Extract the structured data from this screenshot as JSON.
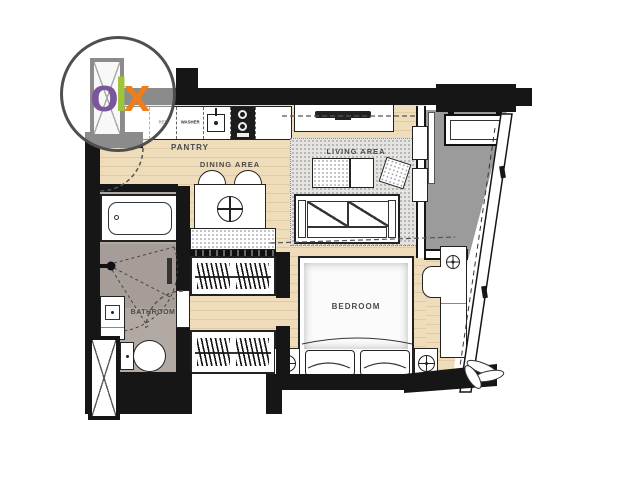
{
  "watermark": {
    "brand": "OLX",
    "letters": {
      "o": "o",
      "l": "l",
      "x": "x"
    },
    "colors": {
      "o": "#7a569d",
      "l": "#9dc43b",
      "x": "#ee7e1b",
      "ring": "#4f4f4f"
    }
  },
  "rooms": {
    "pantry": "PANTRY",
    "dining": "DINING AREA",
    "living": "LIVING AREA",
    "bedroom": "BEDROOM",
    "bathroom": "BATHROOM"
  },
  "fixtures": {
    "ref_label": "REF",
    "washer_label": "WASHER"
  },
  "colors": {
    "wall": "#161616",
    "wood_floor": "#eedcba",
    "balcony_floor": "#9b9b9b",
    "bathroom_tile": "#b3a9a3",
    "shower_tile": "#a79d98",
    "rug": "#e6e4e1"
  }
}
